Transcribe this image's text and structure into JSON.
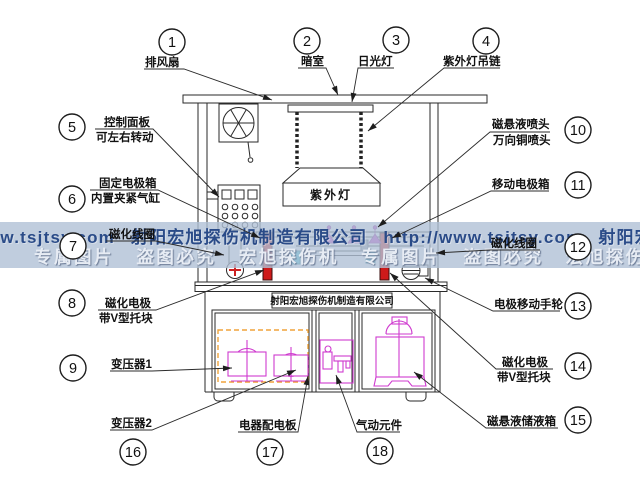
{
  "watermark": {
    "line1": "ww.tsjtsy.com 射阳宏旭探伤机制造有限公司 http://www.tsjtsy.com 射阳宏",
    "line2": "专属图片 盗图必究 宏旭探伤机 专属图片 盗图必究 宏旭探伤机 专属图片",
    "band_color": "#b0c0d6",
    "line1_color": "#2a4b88",
    "line2_color": "#e7ecf4"
  },
  "machine": {
    "uv_lamp_label": "紫外灯",
    "nameplate": "射阳宏旭探伤机制造有限公司"
  },
  "colors": {
    "electrode_red": "#ce1a1a",
    "component_magenta": "#cf3bcf",
    "vblock_cyan": "#35c3d6",
    "dashed_orange": "#f0a43c",
    "line_black": "#2a2a2a"
  },
  "callouts": [
    {
      "num": "1",
      "label": [
        "排风扇"
      ],
      "label_pos": [
        [
          145,
          66
        ]
      ],
      "circle": [
        172,
        42
      ],
      "leader": [
        [
          144,
          69
        ],
        [
          184,
          69
        ],
        [
          272,
          100
        ]
      ]
    },
    {
      "num": "2",
      "label": [
        "暗室"
      ],
      "label_pos": [
        [
          301,
          65
        ]
      ],
      "circle": [
        307,
        41
      ],
      "leader": [
        [
          298,
          68
        ],
        [
          326,
          68
        ],
        [
          338,
          95
        ]
      ]
    },
    {
      "num": "3",
      "label": [
        "日光灯"
      ],
      "label_pos": [
        [
          358,
          65
        ]
      ],
      "circle": [
        396,
        40
      ],
      "leader": [
        [
          394,
          68
        ],
        [
          358,
          68
        ],
        [
          352,
          102
        ]
      ]
    },
    {
      "num": "4",
      "label": [
        "紫外灯吊链"
      ],
      "label_pos": [
        [
          443,
          65
        ]
      ],
      "circle": [
        486,
        41
      ],
      "leader": [
        [
          500,
          68
        ],
        [
          444,
          68
        ],
        [
          368,
          131
        ]
      ]
    },
    {
      "num": "5",
      "label": [
        "控制面板",
        "可左右转动"
      ],
      "label_pos": [
        [
          104,
          126
        ],
        [
          96,
          141
        ]
      ],
      "circle": [
        72,
        127
      ],
      "leader": [
        [
          95,
          129
        ],
        [
          153,
          129
        ],
        [
          219,
          197
        ]
      ]
    },
    {
      "num": "6",
      "label": [
        "固定电极箱",
        "内置夹紧气缸"
      ],
      "label_pos": [
        [
          99,
          187
        ],
        [
          91,
          202
        ]
      ],
      "circle": [
        72,
        199
      ],
      "leader": [
        [
          90,
          190
        ],
        [
          158,
          190
        ],
        [
          260,
          238
        ]
      ]
    },
    {
      "num": "7",
      "label": [
        "磁化线圈"
      ],
      "label_pos": [
        [
          109,
          238
        ]
      ],
      "circle": [
        73,
        246
      ],
      "leader": [
        [
          106,
          241
        ],
        [
          156,
          241
        ],
        [
          224,
          255
        ]
      ]
    },
    {
      "num": "8",
      "label": [
        "磁化电极",
        "带V型托块"
      ],
      "label_pos": [
        [
          105,
          307
        ],
        [
          99,
          322
        ]
      ],
      "circle": [
        72,
        303
      ],
      "leader": [
        [
          98,
          310
        ],
        [
          156,
          310
        ],
        [
          264,
          270
        ]
      ]
    },
    {
      "num": "9",
      "label": [
        "变压器1"
      ],
      "label_pos": [
        [
          111,
          368
        ]
      ],
      "circle": [
        73,
        368
      ],
      "leader": [
        [
          110,
          371
        ],
        [
          152,
          371
        ],
        [
          232,
          368
        ]
      ]
    },
    {
      "num": "10",
      "label": [
        "磁悬液喷头",
        "万向铜喷头"
      ],
      "label_pos": [
        [
          492,
          128
        ],
        [
          493,
          144
        ]
      ],
      "circle": [
        578,
        130
      ],
      "leader": [
        [
          550,
          132
        ],
        [
          490,
          132
        ],
        [
          378,
          227
        ]
      ]
    },
    {
      "num": "11",
      "label": [
        "移动电极箱"
      ],
      "label_pos": [
        [
          492,
          188
        ]
      ],
      "circle": [
        578,
        185
      ],
      "leader": [
        [
          549,
          191
        ],
        [
          491,
          191
        ],
        [
          392,
          238
        ]
      ]
    },
    {
      "num": "12",
      "label": [
        "磁化线圈"
      ],
      "label_pos": [
        [
          491,
          247
        ]
      ],
      "circle": [
        578,
        247
      ],
      "leader": [
        [
          540,
          250
        ],
        [
          490,
          250
        ],
        [
          436,
          253
        ]
      ]
    },
    {
      "num": "13",
      "label": [
        "电极移动手轮"
      ],
      "label_pos": [
        [
          494,
          308
        ]
      ],
      "circle": [
        578,
        306
      ],
      "leader": [
        [
          560,
          311
        ],
        [
          493,
          311
        ],
        [
          425,
          278
        ]
      ]
    },
    {
      "num": "14",
      "label": [
        "磁化电极",
        "带V型托块"
      ],
      "label_pos": [
        [
          502,
          366
        ],
        [
          497,
          381
        ]
      ],
      "circle": [
        578,
        366
      ],
      "leader": [
        [
          553,
          369
        ],
        [
          496,
          369
        ],
        [
          390,
          273
        ]
      ]
    },
    {
      "num": "15",
      "label": [
        "磁悬液储液箱"
      ],
      "label_pos": [
        [
          487,
          425
        ]
      ],
      "circle": [
        578,
        420
      ],
      "leader": [
        [
          558,
          428
        ],
        [
          486,
          428
        ],
        [
          414,
          372
        ]
      ]
    },
    {
      "num": "16",
      "label": [
        "变压器2"
      ],
      "label_pos": [
        [
          111,
          427
        ]
      ],
      "circle": [
        133,
        452
      ],
      "leader": [
        [
          110,
          430
        ],
        [
          152,
          430
        ],
        [
          296,
          370
        ]
      ]
    },
    {
      "num": "17",
      "label": [
        "电器配电板"
      ],
      "label_pos": [
        [
          239,
          429
        ]
      ],
      "circle": [
        270,
        452
      ],
      "leader": [
        [
          238,
          432
        ],
        [
          298,
          432
        ],
        [
          308,
          376
        ]
      ]
    },
    {
      "num": "18",
      "label": [
        "气动元件"
      ],
      "label_pos": [
        [
          356,
          429
        ]
      ],
      "circle": [
        380,
        451
      ],
      "leader": [
        [
          400,
          432
        ],
        [
          357,
          432
        ],
        [
          336,
          375
        ]
      ]
    }
  ]
}
